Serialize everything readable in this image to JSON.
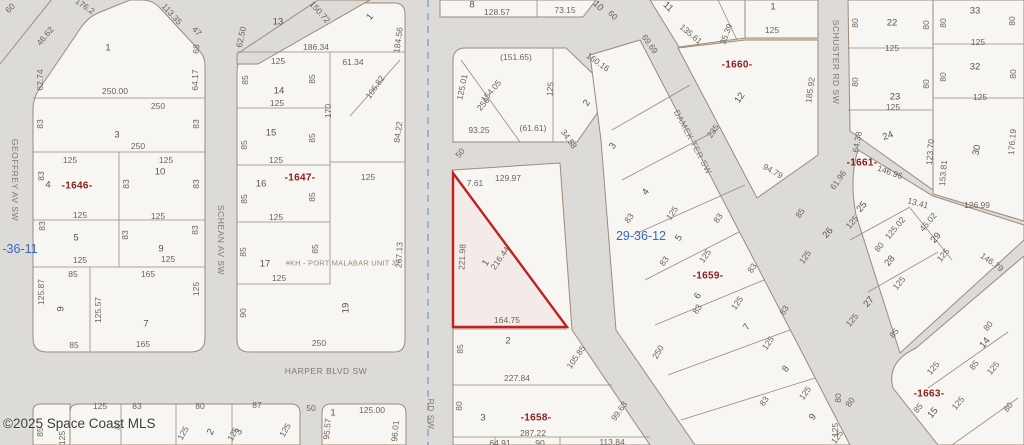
{
  "colors": {
    "road": "#dcdbd8",
    "parcel": "#f7f6f3",
    "parcel_line": "#a08a76",
    "lot_line": "#968b7e",
    "highlight": "#c02020",
    "section_line": "#7b9cc4",
    "text": "#6d645b",
    "block_text": "#8b1c1c",
    "section_text": "#3a67c0",
    "watermark_text": "#3c3c3c"
  },
  "watermark": {
    "text": "©2025 Space Coast MLS"
  },
  "highlight": {
    "lot": "1",
    "outline_color": "#c02020",
    "dimensions": [
      "7.61",
      "129.97",
      "221.98",
      "216.44",
      "164.75"
    ]
  },
  "streets": [
    "GEOFFREY AV SW",
    "SCHEAN AV SW",
    "HARPER BLVD SW",
    "DAMEK TER SW",
    "SCHUSTER RD SW",
    "RD SW"
  ],
  "blocks": [
    "-1646-",
    "-1647-",
    "-1658-",
    "-1659-",
    "-1660-",
    "-1661-",
    "-1663-"
  ],
  "sections": [
    "-36-11",
    "29-36-12"
  ],
  "plat_note": "#KH - PORT MALABAR UNIT 37",
  "labels": [
    {
      "t": "GEOFFREY AV SW",
      "x": 15,
      "y": 180,
      "r": 90,
      "c": "street"
    },
    {
      "t": "SCHEAN AV SW",
      "x": 221,
      "y": 240,
      "r": 90,
      "c": "street"
    },
    {
      "t": "HARPER BLVD SW",
      "x": 326,
      "y": 371,
      "c": "street"
    },
    {
      "t": "DAMEK TER SW",
      "x": 693,
      "y": 142,
      "r": 62,
      "c": "street"
    },
    {
      "t": "SCHUSTER RD SW",
      "x": 836,
      "y": 62,
      "r": 90,
      "c": "street"
    },
    {
      "t": "RD SW",
      "x": 431,
      "y": 414,
      "r": 90,
      "c": "street"
    },
    {
      "t": "-36-11",
      "x": 20,
      "y": 249,
      "c": "section"
    },
    {
      "t": "29-36-12",
      "x": 641,
      "y": 236,
      "c": "section"
    },
    {
      "t": "-1646-",
      "x": 77,
      "y": 186,
      "c": "block"
    },
    {
      "t": "-1647-",
      "x": 300,
      "y": 178,
      "c": "block"
    },
    {
      "t": "-1660-",
      "x": 737,
      "y": 65,
      "c": "block"
    },
    {
      "t": "-1659-",
      "x": 708,
      "y": 276,
      "c": "block"
    },
    {
      "t": "-1658-",
      "x": 536,
      "y": 418,
      "c": "block"
    },
    {
      "t": "-1661-",
      "x": 862,
      "y": 163,
      "c": "block"
    },
    {
      "t": "-1663-",
      "x": 929,
      "y": 394,
      "c": "block"
    },
    {
      "t": "#KH - PORT MALABAR UNIT 37",
      "x": 343,
      "y": 263,
      "c": "note"
    },
    {
      "t": "1",
      "x": 108,
      "y": 48,
      "c": "lot"
    },
    {
      "t": "3",
      "x": 117,
      "y": 135,
      "c": "lot"
    },
    {
      "t": "4",
      "x": 48,
      "y": 185,
      "c": "lot"
    },
    {
      "t": "10",
      "x": 160,
      "y": 172,
      "c": "lot"
    },
    {
      "t": "5",
      "x": 76,
      "y": 238,
      "c": "lot"
    },
    {
      "t": "9",
      "x": 161,
      "y": 249,
      "c": "lot"
    },
    {
      "t": "9",
      "x": 61,
      "y": 309,
      "r": -90,
      "c": "lot"
    },
    {
      "t": "7",
      "x": 146,
      "y": 324,
      "c": "lot"
    },
    {
      "t": "13",
      "x": 278,
      "y": 22,
      "c": "lot"
    },
    {
      "t": "1",
      "x": 370,
      "y": 17,
      "r": -50,
      "c": "lot"
    },
    {
      "t": "14",
      "x": 279,
      "y": 91,
      "c": "lot"
    },
    {
      "t": "15",
      "x": 271,
      "y": 133,
      "c": "lot"
    },
    {
      "t": "16",
      "x": 261,
      "y": 184,
      "c": "lot"
    },
    {
      "t": "17",
      "x": 265,
      "y": 264,
      "c": "lot"
    },
    {
      "t": "19",
      "x": 346,
      "y": 308,
      "r": -90,
      "c": "lot"
    },
    {
      "t": "8",
      "x": 472,
      "y": 5,
      "c": "lot"
    },
    {
      "t": "10",
      "x": 598,
      "y": 6,
      "r": 45,
      "c": "lot"
    },
    {
      "t": "11",
      "x": 668,
      "y": 7,
      "r": 45,
      "c": "lot"
    },
    {
      "t": "1",
      "x": 773,
      "y": 7,
      "c": "lot"
    },
    {
      "t": "12",
      "x": 740,
      "y": 98,
      "r": -55,
      "c": "lot"
    },
    {
      "t": "2",
      "x": 587,
      "y": 103,
      "r": -55,
      "c": "lot"
    },
    {
      "t": "3",
      "x": 613,
      "y": 146,
      "r": -55,
      "c": "lot"
    },
    {
      "t": "1",
      "x": 486,
      "y": 263,
      "r": -55,
      "c": "lot"
    },
    {
      "t": "2",
      "x": 508,
      "y": 341,
      "c": "lot"
    },
    {
      "t": "3",
      "x": 483,
      "y": 418,
      "c": "lot"
    },
    {
      "t": "4",
      "x": 646,
      "y": 192,
      "r": -55,
      "c": "lot"
    },
    {
      "t": "5",
      "x": 679,
      "y": 238,
      "r": -55,
      "c": "lot"
    },
    {
      "t": "6",
      "x": 698,
      "y": 296,
      "r": -55,
      "c": "lot"
    },
    {
      "t": "7",
      "x": 747,
      "y": 327,
      "r": -55,
      "c": "lot"
    },
    {
      "t": "8",
      "x": 786,
      "y": 369,
      "r": -55,
      "c": "lot"
    },
    {
      "t": "9",
      "x": 813,
      "y": 417,
      "r": -55,
      "c": "lot"
    },
    {
      "t": "22",
      "x": 892,
      "y": 23,
      "c": "lot"
    },
    {
      "t": "23",
      "x": 895,
      "y": 97,
      "c": "lot"
    },
    {
      "t": "24",
      "x": 888,
      "y": 136,
      "r": -20,
      "c": "lot"
    },
    {
      "t": "33",
      "x": 975,
      "y": 11,
      "c": "lot"
    },
    {
      "t": "32",
      "x": 975,
      "y": 67,
      "c": "lot"
    },
    {
      "t": "30",
      "x": 977,
      "y": 150,
      "r": -80,
      "c": "lot"
    },
    {
      "t": "25",
      "x": 862,
      "y": 207,
      "r": -50,
      "c": "lot"
    },
    {
      "t": "26",
      "x": 828,
      "y": 233,
      "r": -50,
      "c": "lot"
    },
    {
      "t": "28",
      "x": 890,
      "y": 261,
      "r": -50,
      "c": "lot"
    },
    {
      "t": "29",
      "x": 936,
      "y": 238,
      "r": -50,
      "c": "lot"
    },
    {
      "t": "27",
      "x": 869,
      "y": 302,
      "r": -50,
      "c": "lot"
    },
    {
      "t": "14",
      "x": 985,
      "y": 343,
      "r": -50,
      "c": "lot"
    },
    {
      "t": "15",
      "x": 933,
      "y": 413,
      "r": -50,
      "c": "lot"
    },
    {
      "t": "1",
      "x": 333,
      "y": 413,
      "c": "lot"
    },
    {
      "t": "3",
      "x": 239,
      "y": 432,
      "r": -60,
      "c": "lot"
    },
    {
      "t": "2",
      "x": 211,
      "y": 432,
      "r": -60,
      "c": "lot"
    },
    {
      "t": "60",
      "x": 10,
      "y": 8,
      "r": -45
    },
    {
      "t": "176.2",
      "x": 85,
      "y": 6,
      "r": 35
    },
    {
      "t": "46.62",
      "x": 45,
      "y": 36,
      "r": -50
    },
    {
      "t": "113.35",
      "x": 172,
      "y": 14,
      "r": 48
    },
    {
      "t": "47",
      "x": 197,
      "y": 31,
      "r": 48
    },
    {
      "t": "68",
      "x": 196,
      "y": 49,
      "r": -85
    },
    {
      "t": "62.74",
      "x": 40,
      "y": 80,
      "r": -90
    },
    {
      "t": "64.17",
      "x": 195,
      "y": 80,
      "r": -90
    },
    {
      "t": "250.00",
      "x": 115,
      "y": 91
    },
    {
      "t": "250",
      "x": 158,
      "y": 106
    },
    {
      "t": "83",
      "x": 40,
      "y": 124,
      "r": -90
    },
    {
      "t": "83",
      "x": 196,
      "y": 124,
      "r": -90
    },
    {
      "t": "250",
      "x": 138,
      "y": 146
    },
    {
      "t": "125",
      "x": 70,
      "y": 160
    },
    {
      "t": "125",
      "x": 166,
      "y": 160
    },
    {
      "t": "83",
      "x": 41,
      "y": 176,
      "r": -90
    },
    {
      "t": "83",
      "x": 126,
      "y": 184,
      "r": -90
    },
    {
      "t": "83",
      "x": 196,
      "y": 184,
      "r": -90
    },
    {
      "t": "125",
      "x": 80,
      "y": 215
    },
    {
      "t": "125",
      "x": 158,
      "y": 216
    },
    {
      "t": "83",
      "x": 42,
      "y": 226,
      "r": -90
    },
    {
      "t": "83",
      "x": 125,
      "y": 235,
      "r": -90
    },
    {
      "t": "83",
      "x": 195,
      "y": 230,
      "r": -90
    },
    {
      "t": "125",
      "x": 80,
      "y": 260
    },
    {
      "t": "125",
      "x": 168,
      "y": 259
    },
    {
      "t": "85",
      "x": 73,
      "y": 274
    },
    {
      "t": "165",
      "x": 148,
      "y": 274
    },
    {
      "t": "125.87",
      "x": 41,
      "y": 292,
      "r": -90
    },
    {
      "t": "125.57",
      "x": 98,
      "y": 310,
      "r": -90
    },
    {
      "t": "125",
      "x": 196,
      "y": 289,
      "r": -90
    },
    {
      "t": "85",
      "x": 74,
      "y": 345
    },
    {
      "t": "165",
      "x": 143,
      "y": 344
    },
    {
      "t": "150.72",
      "x": 320,
      "y": 12,
      "r": 48
    },
    {
      "t": "62.50",
      "x": 241,
      "y": 37,
      "r": -78
    },
    {
      "t": "186.34",
      "x": 316,
      "y": 47
    },
    {
      "t": "184.56",
      "x": 398,
      "y": 40,
      "r": -82
    },
    {
      "t": "125",
      "x": 278,
      "y": 61
    },
    {
      "t": "61.34",
      "x": 353,
      "y": 62
    },
    {
      "t": "85",
      "x": 245,
      "y": 80,
      "r": -90
    },
    {
      "t": "85",
      "x": 312,
      "y": 79,
      "r": -90
    },
    {
      "t": "106.82",
      "x": 375,
      "y": 87,
      "r": -55
    },
    {
      "t": "125",
      "x": 277,
      "y": 103
    },
    {
      "t": "170",
      "x": 328,
      "y": 111,
      "r": -90
    },
    {
      "t": "84.22",
      "x": 398,
      "y": 132,
      "r": -82
    },
    {
      "t": "85",
      "x": 244,
      "y": 145,
      "r": -90
    },
    {
      "t": "85",
      "x": 312,
      "y": 138,
      "r": -90
    },
    {
      "t": "125",
      "x": 276,
      "y": 160
    },
    {
      "t": "125",
      "x": 368,
      "y": 177
    },
    {
      "t": "85",
      "x": 244,
      "y": 199,
      "r": -90
    },
    {
      "t": "85",
      "x": 312,
      "y": 197,
      "r": -90
    },
    {
      "t": "125",
      "x": 276,
      "y": 217
    },
    {
      "t": "85",
      "x": 243,
      "y": 252,
      "r": -90
    },
    {
      "t": "85",
      "x": 315,
      "y": 249,
      "r": -90
    },
    {
      "t": "125",
      "x": 279,
      "y": 278
    },
    {
      "t": "267.13",
      "x": 399,
      "y": 255,
      "r": -87
    },
    {
      "t": "90",
      "x": 243,
      "y": 313,
      "r": -90
    },
    {
      "t": "250",
      "x": 319,
      "y": 343
    },
    {
      "t": "128.57",
      "x": 497,
      "y": 12
    },
    {
      "t": "73.15",
      "x": 565,
      "y": 10
    },
    {
      "t": "60",
      "x": 613,
      "y": 15,
      "r": 45
    },
    {
      "t": "(151.65)",
      "x": 516,
      "y": 57
    },
    {
      "t": "125.01",
      "x": 462,
      "y": 87,
      "r": -78
    },
    {
      "t": "154.05",
      "x": 491,
      "y": 91,
      "r": -50
    },
    {
      "t": "250",
      "x": 483,
      "y": 104,
      "r": -50
    },
    {
      "t": "125",
      "x": 550,
      "y": 89,
      "r": -85
    },
    {
      "t": "160.16",
      "x": 598,
      "y": 62,
      "r": 35
    },
    {
      "t": "93.25",
      "x": 479,
      "y": 130
    },
    {
      "t": "(61.61)",
      "x": 533,
      "y": 128
    },
    {
      "t": "34.58",
      "x": 569,
      "y": 139,
      "r": 55
    },
    {
      "t": "50",
      "x": 460,
      "y": 153,
      "r": -50
    },
    {
      "t": "7.61",
      "x": 475,
      "y": 183
    },
    {
      "t": "129.97",
      "x": 508,
      "y": 178
    },
    {
      "t": "221.98",
      "x": 462,
      "y": 257,
      "r": -87
    },
    {
      "t": "216.44",
      "x": 500,
      "y": 258,
      "r": -55
    },
    {
      "t": "164.75",
      "x": 507,
      "y": 320
    },
    {
      "t": "85",
      "x": 460,
      "y": 349,
      "r": -90
    },
    {
      "t": "227.84",
      "x": 517,
      "y": 378
    },
    {
      "t": "105.85",
      "x": 576,
      "y": 357,
      "r": -55
    },
    {
      "t": "80",
      "x": 459,
      "y": 406,
      "r": -90
    },
    {
      "t": "287.22",
      "x": 533,
      "y": 433
    },
    {
      "t": "99.63",
      "x": 619,
      "y": 411,
      "r": -55
    },
    {
      "t": "250",
      "x": 658,
      "y": 352,
      "r": -60
    },
    {
      "t": "64.91",
      "x": 500,
      "y": 443
    },
    {
      "t": "90",
      "x": 540,
      "y": 443
    },
    {
      "t": "113.84",
      "x": 612,
      "y": 442
    },
    {
      "t": "69.69",
      "x": 650,
      "y": 44,
      "r": 55
    },
    {
      "t": "135.61",
      "x": 691,
      "y": 34,
      "r": 40
    },
    {
      "t": "35.39",
      "x": 726,
      "y": 34,
      "r": -70
    },
    {
      "t": "125",
      "x": 772,
      "y": 30
    },
    {
      "t": "185.92",
      "x": 810,
      "y": 90,
      "r": -82
    },
    {
      "t": "235",
      "x": 713,
      "y": 131,
      "r": -55
    },
    {
      "t": "94.79",
      "x": 773,
      "y": 171,
      "r": 30
    },
    {
      "t": "61.96",
      "x": 838,
      "y": 180,
      "r": -55
    },
    {
      "t": "83",
      "x": 629,
      "y": 218,
      "r": -55
    },
    {
      "t": "125",
      "x": 672,
      "y": 213,
      "r": -55
    },
    {
      "t": "83",
      "x": 718,
      "y": 218,
      "r": -55
    },
    {
      "t": "83",
      "x": 664,
      "y": 261,
      "r": -55
    },
    {
      "t": "125",
      "x": 705,
      "y": 256,
      "r": -55
    },
    {
      "t": "83",
      "x": 752,
      "y": 268,
      "r": -55
    },
    {
      "t": "83",
      "x": 697,
      "y": 309,
      "r": -55
    },
    {
      "t": "125",
      "x": 737,
      "y": 303,
      "r": -55
    },
    {
      "t": "83",
      "x": 784,
      "y": 310,
      "r": -55
    },
    {
      "t": "125",
      "x": 768,
      "y": 343,
      "r": -55
    },
    {
      "t": "83",
      "x": 764,
      "y": 401,
      "r": -55
    },
    {
      "t": "125",
      "x": 805,
      "y": 393,
      "r": -55
    },
    {
      "t": "85",
      "x": 800,
      "y": 213,
      "r": -55
    },
    {
      "t": "125",
      "x": 805,
      "y": 257,
      "r": -55
    },
    {
      "t": "125",
      "x": 837,
      "y": 437,
      "r": -55
    },
    {
      "t": "80",
      "x": 850,
      "y": 402,
      "r": -55
    },
    {
      "t": "125",
      "x": 892,
      "y": 48
    },
    {
      "t": "80",
      "x": 855,
      "y": 23,
      "r": -90
    },
    {
      "t": "80",
      "x": 926,
      "y": 25,
      "r": -90
    },
    {
      "t": "125",
      "x": 893,
      "y": 107
    },
    {
      "t": "80",
      "x": 855,
      "y": 82,
      "r": -90
    },
    {
      "t": "80",
      "x": 926,
      "y": 84,
      "r": -90
    },
    {
      "t": "64.38",
      "x": 857,
      "y": 142,
      "r": -80
    },
    {
      "t": "123.70",
      "x": 930,
      "y": 152,
      "r": -85
    },
    {
      "t": "146.96",
      "x": 890,
      "y": 172,
      "r": 20
    },
    {
      "t": "80",
      "x": 943,
      "y": 23,
      "r": -90
    },
    {
      "t": "80",
      "x": 1012,
      "y": 21,
      "r": -90
    },
    {
      "t": "125",
      "x": 978,
      "y": 42
    },
    {
      "t": "80",
      "x": 943,
      "y": 77,
      "r": -90
    },
    {
      "t": "80",
      "x": 1013,
      "y": 74,
      "r": -90
    },
    {
      "t": "125",
      "x": 980,
      "y": 97
    },
    {
      "t": "176.19",
      "x": 1012,
      "y": 142,
      "r": -85
    },
    {
      "t": "153.81",
      "x": 943,
      "y": 173,
      "r": -85
    },
    {
      "t": "126.99",
      "x": 977,
      "y": 205
    },
    {
      "t": "13.41",
      "x": 918,
      "y": 203,
      "r": 15
    },
    {
      "t": "125.02",
      "x": 895,
      "y": 228,
      "r": -50
    },
    {
      "t": "45.02",
      "x": 928,
      "y": 222,
      "r": -50
    },
    {
      "t": "125",
      "x": 852,
      "y": 222,
      "r": -50
    },
    {
      "t": "80",
      "x": 879,
      "y": 247,
      "r": -50
    },
    {
      "t": "125",
      "x": 899,
      "y": 283,
      "r": -50
    },
    {
      "t": "125",
      "x": 943,
      "y": 255,
      "r": -50
    },
    {
      "t": "146.79",
      "x": 992,
      "y": 262,
      "r": 35
    },
    {
      "t": "125",
      "x": 852,
      "y": 320,
      "r": -50
    },
    {
      "t": "85",
      "x": 894,
      "y": 333,
      "r": -50
    },
    {
      "t": "80",
      "x": 988,
      "y": 326,
      "r": -50
    },
    {
      "t": "85",
      "x": 974,
      "y": 365,
      "r": -50
    },
    {
      "t": "125",
      "x": 993,
      "y": 368,
      "r": -50
    },
    {
      "t": "125",
      "x": 933,
      "y": 368,
      "r": -50
    },
    {
      "t": "85",
      "x": 918,
      "y": 408,
      "r": -50
    },
    {
      "t": "125",
      "x": 958,
      "y": 403,
      "r": -50
    },
    {
      "t": "80",
      "x": 1008,
      "y": 407,
      "r": -50
    },
    {
      "t": "80",
      "x": 838,
      "y": 398,
      "r": -90
    },
    {
      "t": "125",
      "x": 835,
      "y": 430,
      "r": -90
    },
    {
      "t": "125",
      "x": 100,
      "y": 406
    },
    {
      "t": "83",
      "x": 137,
      "y": 406
    },
    {
      "t": "80",
      "x": 200,
      "y": 406
    },
    {
      "t": "87",
      "x": 257,
      "y": 405
    },
    {
      "t": "85",
      "x": 40,
      "y": 432,
      "r": -90
    },
    {
      "t": "125",
      "x": 62,
      "y": 438,
      "r": -90
    },
    {
      "t": "85",
      "x": 118,
      "y": 425,
      "r": -75
    },
    {
      "t": "125",
      "x": 183,
      "y": 433,
      "r": -60
    },
    {
      "t": "125",
      "x": 233,
      "y": 434,
      "r": -60
    },
    {
      "t": "125",
      "x": 285,
      "y": 430,
      "r": -60
    },
    {
      "t": "50",
      "x": 311,
      "y": 408
    },
    {
      "t": "125.00",
      "x": 372,
      "y": 410
    },
    {
      "t": "95.57",
      "x": 327,
      "y": 429,
      "r": -85
    },
    {
      "t": "96.01",
      "x": 395,
      "y": 431,
      "r": -85
    }
  ]
}
